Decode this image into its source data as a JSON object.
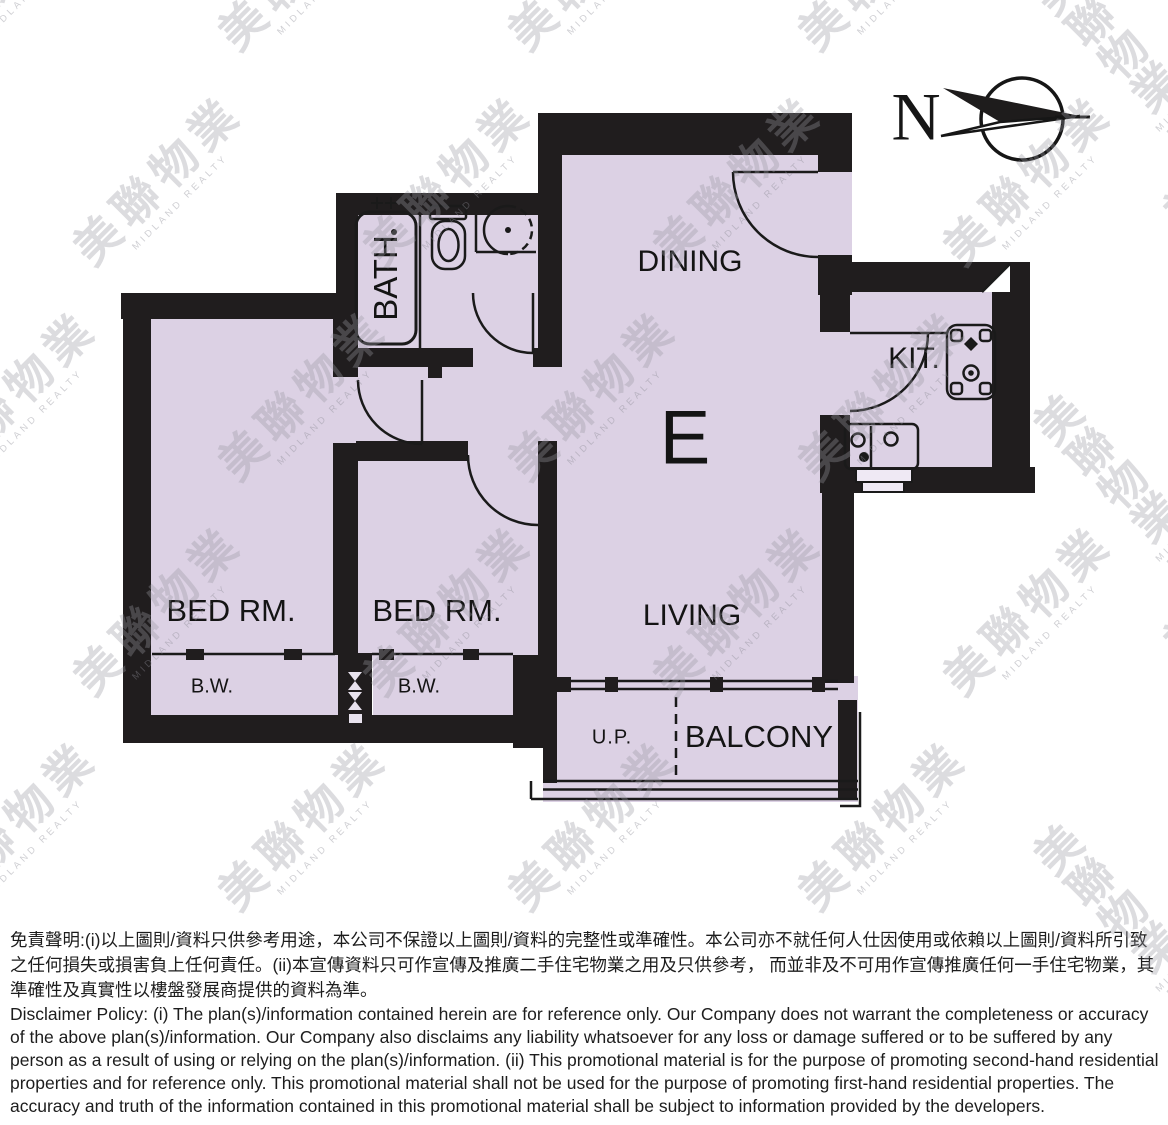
{
  "compass": {
    "label": "N"
  },
  "floor_plan": {
    "unit_label": "E",
    "rooms": {
      "dining": "DINING",
      "living": "LIVING",
      "bath": "BATH",
      "kitchen": "KIT.",
      "bedroom1": "BED RM.",
      "bedroom2": "BED RM.",
      "bw1": "B.W.",
      "bw2": "B.W.",
      "up": "U.P.",
      "balcony": "BALCONY"
    },
    "colors": {
      "room_fill": "#dcd1e4",
      "wall": "#201d1e"
    }
  },
  "watermark": {
    "cjk": "美聯物業",
    "latin": "MIDLAND REALTY"
  },
  "disclaimer": {
    "chinese": "免責聲明:(i)以上圖則/資料只供參考用途，本公司不保證以上圖則/資料的完整性或準確性。本公司亦不就任何人仕因使用或依賴以上圖則/資料所引致之任何損失或損害負上任何責任。(ii)本宣傳資料只可作宣傳及推廣二手住宅物業之用及只供參考， 而並非及不可用作宣傳推廣任何一手住宅物業，其準確性及真實性以樓盤發展商提供的資料為準。",
    "english": "Disclaimer Policy: (i) The plan(s)/information contained herein are for reference only. Our Company does not warrant the completeness or accuracy of the above plan(s)/information. Our Company also disclaims any liability whatsoever for any loss or damage suffered or to be suffered by any person as a result of using or relying on the plan(s)/information. (ii) This promotional material is for the purpose of promoting second-hand residential properties and for reference only. This promotional material shall not be used for the purpose of promoting first-hand residential properties. The accuracy and truth of the information contained in this promotional material shall be subject to information provided by the developers."
  }
}
